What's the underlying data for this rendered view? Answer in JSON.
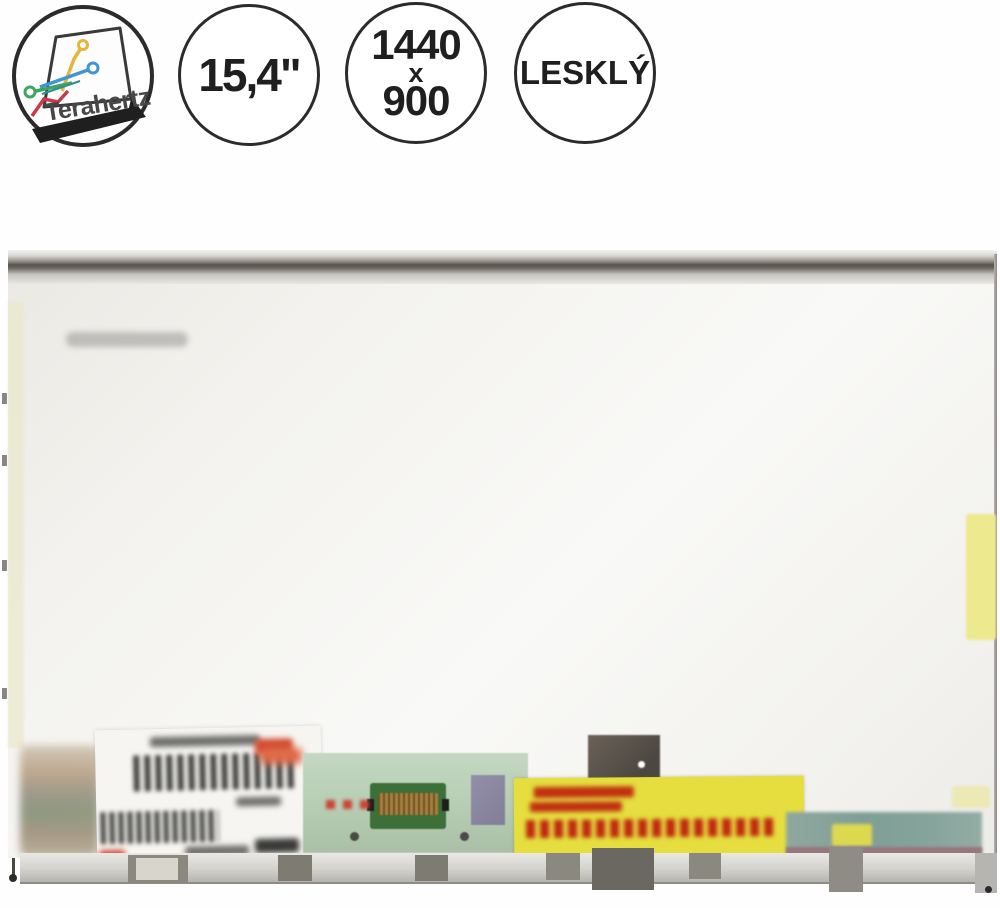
{
  "badges": {
    "logo": {
      "brand": "Terahertz"
    },
    "size": {
      "label": "15,4\""
    },
    "resolution": {
      "width": "1440",
      "separator": "x",
      "height": "900"
    },
    "finish": {
      "label": "LESKLÝ"
    }
  },
  "colors": {
    "badge_outline": "#2b2b2b",
    "badge_text": "#1f1f1f",
    "pcb_green": "#bcd2ba",
    "yellow_label": "#e5de3e",
    "label_red_text": "#c03010",
    "tape_yellow": "#ece98f",
    "screen_white": "#f6f5f2"
  }
}
